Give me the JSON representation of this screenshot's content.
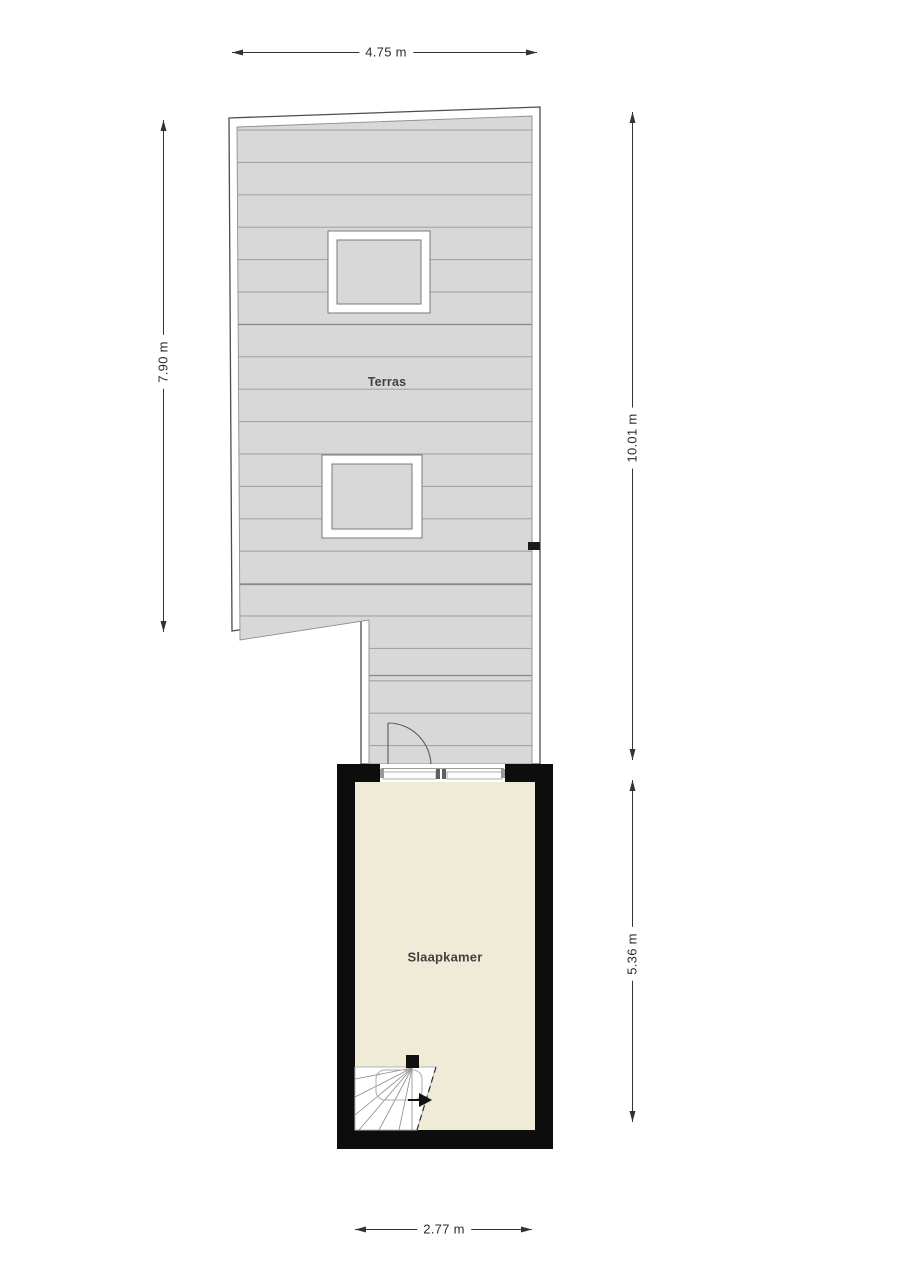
{
  "plan": {
    "rooms": {
      "terras": {
        "label": "Terras"
      },
      "slaapkamer": {
        "label": "Slaapkamer"
      }
    },
    "dimensions": {
      "terrace_width_top": {
        "label": "4.75 m",
        "orientation": "horizontal",
        "position": "top"
      },
      "terrace_height_left": {
        "label": "7.90 m",
        "orientation": "vertical",
        "position": "left"
      },
      "total_height_right": {
        "label": "10.01 m",
        "orientation": "vertical",
        "position": "right-upper"
      },
      "bedroom_height_right": {
        "label": "5.36 m",
        "orientation": "vertical",
        "position": "right-lower"
      },
      "bedroom_width_bottom": {
        "label": "2.77 m",
        "orientation": "horizontal",
        "position": "bottom"
      }
    },
    "symbols": [
      "skylight",
      "skylight",
      "door-swing",
      "winder-stairs",
      "stair-direction-arrow",
      "wall-junction-marker"
    ],
    "colors": {
      "background": "#ffffff",
      "terrace_deck": "#d8d8d8",
      "deck_plank_line": "#9e9e9e",
      "plan_outline": "#4d4d4d",
      "wall_fill": "#0d0d0d",
      "bedroom_floor": "#f0ebd7",
      "dimension_ink": "#2b2b2b"
    }
  }
}
